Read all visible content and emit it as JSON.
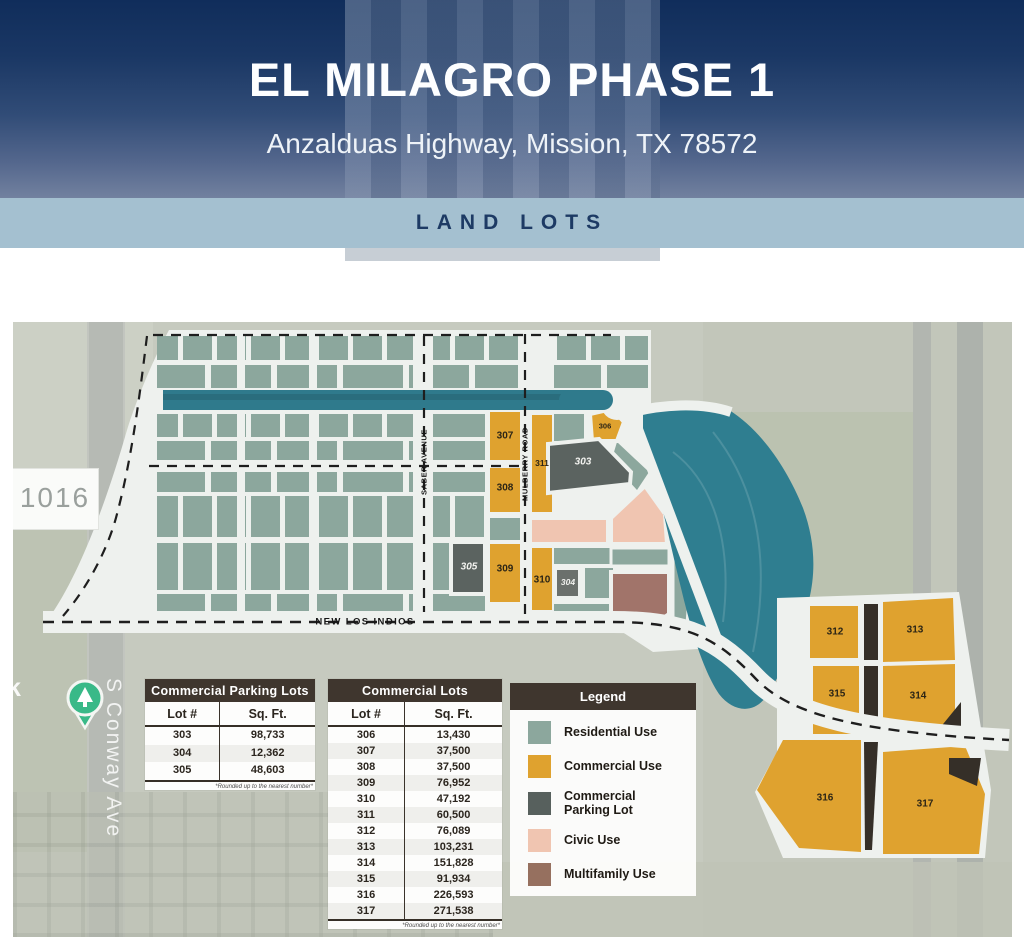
{
  "header": {
    "title": "EL MILAGRO PHASE 1",
    "subtitle": "Anzalduas Highway, Mission, TX 78572",
    "banner": "LAND LOTS"
  },
  "map": {
    "highway_sign": "1016",
    "street_conway": "S Conway Ave",
    "street_partial": "k",
    "street_saber": "SABER AVENUE",
    "street_mulberry": "MULBERRY ROAD",
    "street_new_los_indios": "NEW LOS INDIOS",
    "lots": {
      "n303": "303",
      "n304": "304",
      "n305": "305",
      "n306": "306",
      "n307": "307",
      "n308": "308",
      "n309": "309",
      "n310": "310",
      "n311": "311",
      "n312": "312",
      "n313": "313",
      "n314": "314",
      "n315": "315",
      "n316": "316",
      "n317": "317"
    }
  },
  "tables": {
    "parking": {
      "title": "Commercial Parking Lots",
      "col_lot": "Lot #",
      "col_sqft": "Sq. Ft.",
      "rows": [
        [
          "303",
          "98,733"
        ],
        [
          "304",
          "12,362"
        ],
        [
          "305",
          "48,603"
        ]
      ],
      "footnote": "*Rounded up to the nearest number*"
    },
    "commercial": {
      "title": "Commercial Lots",
      "col_lot": "Lot #",
      "col_sqft": "Sq. Ft.",
      "rows": [
        [
          "306",
          "13,430"
        ],
        [
          "307",
          "37,500"
        ],
        [
          "308",
          "37,500"
        ],
        [
          "309",
          "76,952"
        ],
        [
          "310",
          "47,192"
        ],
        [
          "311",
          "60,500"
        ],
        [
          "312",
          "76,089"
        ],
        [
          "313",
          "103,231"
        ],
        [
          "314",
          "151,828"
        ],
        [
          "315",
          "91,934"
        ],
        [
          "316",
          "226,593"
        ],
        [
          "317",
          "271,538"
        ]
      ],
      "footnote": "*Rounded up to the nearest number*"
    }
  },
  "legend": {
    "title": "Legend",
    "items": [
      {
        "label": "Residential Use",
        "color": "#8ca79d"
      },
      {
        "label": "Commercial Use",
        "color": "#dfa22f"
      },
      {
        "label": "Commercial Parking Lot",
        "color": "#57605d"
      },
      {
        "label": "Civic Use",
        "color": "#f0c5b1"
      },
      {
        "label": "Multifamily Use",
        "color": "#96705f"
      }
    ]
  },
  "colors": {
    "header_top": "#102d5b",
    "header_bottom": "#72819f",
    "band": "#a4c0d0",
    "band_text": "#1d3a64",
    "residential": "#8ca79d",
    "commercial": "#dfa22f",
    "parking_lot": "#57605d",
    "civic": "#f0c5b1",
    "multifamily": "#a1746a",
    "water": "#2f7e90",
    "table_header": "#3f362e",
    "street_white": "#eef1ee"
  }
}
